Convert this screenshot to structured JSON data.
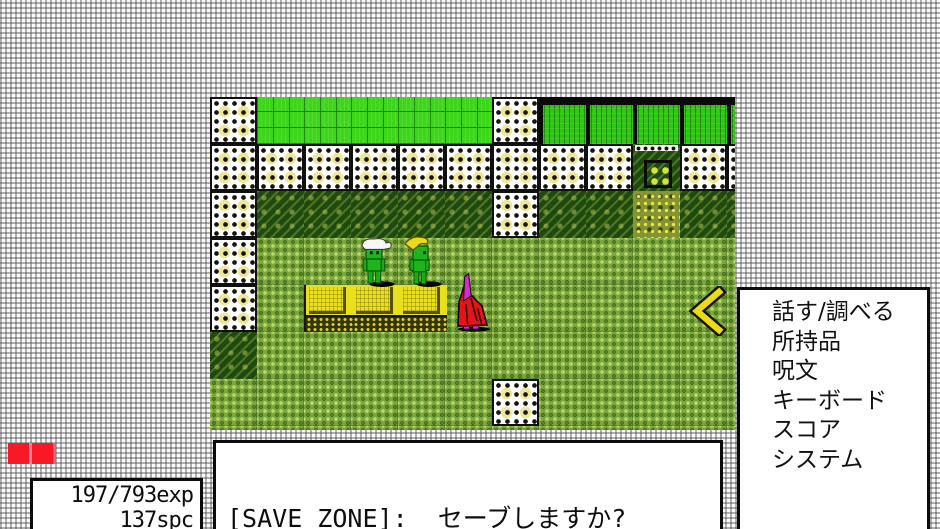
{
  "menu": {
    "items": [
      "話す/調べる",
      "所持品",
      "呪文",
      "キーボード",
      "スコア",
      "システム"
    ]
  },
  "dialog": {
    "text": "[SAVE ZONE]:  セーブしますか?"
  },
  "stats": {
    "exp": "197/793exp",
    "spc": "137spc"
  },
  "map": {
    "legend": {
      "W": "wall",
      "G": "grass",
      "H": "hedge",
      "K": "dark",
      "M": "mid",
      "Y": "speckle",
      "D": "door",
      "T": "table"
    },
    "rows": [
      "WGGGGGWHHHHH",
      "WWWWWWWWWDWW",
      "WKKKKKWKKYKK",
      "WMMMMMMMMMMM",
      "WMTTTMMMMMMM",
      "KMMMMMMMMMMM",
      "MMMMMMWMMMMM",
      "MMMMMMMMMMMM"
    ],
    "sprites": [
      {
        "name": "goblin-white-hair",
        "desc": "green goblin with white hair"
      },
      {
        "name": "goblin-yellow-horn",
        "desc": "green goblin with yellow horn hat"
      },
      {
        "name": "red-cloaked-creature",
        "desc": "red and magenta cloaked creature"
      },
      {
        "name": "yellow-chevron",
        "desc": "yellow left-pointing chevron marker"
      }
    ]
  },
  "colors": {
    "mid_green": "#7ca63c",
    "dark_green": "#20490f",
    "bright_green": "#3ed61c",
    "table_yellow": "#e9df1d",
    "red_bar": "#f91826",
    "arrow_yellow": "#ecd918",
    "window_bg": "#ffffff",
    "text": "#0d0d0d"
  }
}
